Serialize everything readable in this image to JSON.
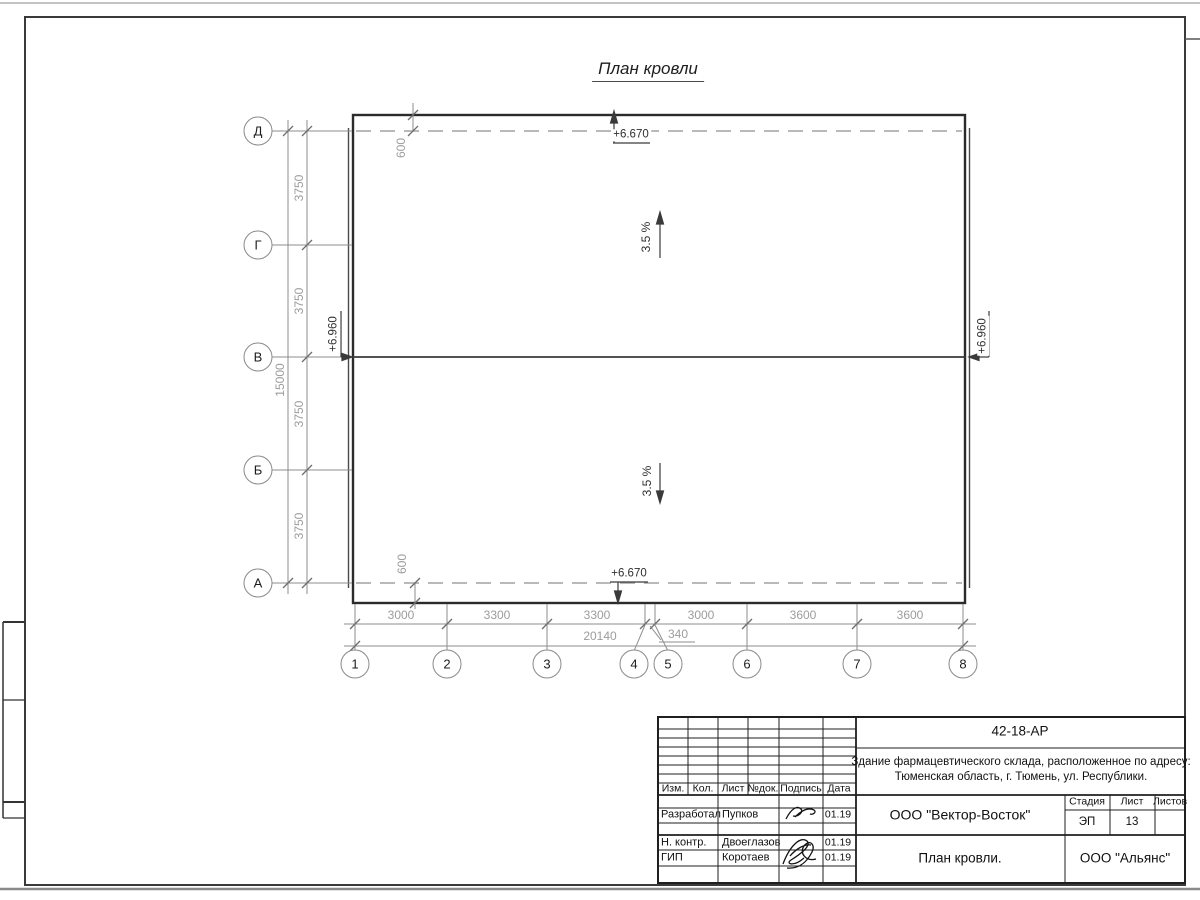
{
  "page": {
    "title": "План кровли"
  },
  "axes": {
    "rows": [
      "Д",
      "Г",
      "В",
      "Б",
      "А"
    ],
    "cols": [
      "1",
      "2",
      "3",
      "4",
      "5",
      "6",
      "7",
      "8"
    ]
  },
  "dims": {
    "row_segments": [
      "3750",
      "3750",
      "3750",
      "3750"
    ],
    "row_total": "15000",
    "col_segments": [
      "3000",
      "3300",
      "3300",
      "3000",
      "3600",
      "3600"
    ],
    "col_gap": "340",
    "col_total": "20140",
    "overhang_top": "600",
    "overhang_bottom": "600"
  },
  "marks": {
    "elev_top": "+6.670",
    "elev_bottom": "+6.670",
    "elev_left": "+6.960",
    "elev_right": "+6.960",
    "slope_top": "3.5 %",
    "slope_bottom": "3.5 %"
  },
  "titleblock": {
    "doc_code": "42-18-АР",
    "address_line1": "Здание фармацевтического склада, расположенное по адресу:",
    "address_line2": "Тюменская область, г. Тюмень, ул. Республики.",
    "org": "ООО \"Вектор-Восток\"",
    "sheet_title": "План кровли.",
    "contractor": "ООО \"Альянс\"",
    "cols": {
      "izm": "Изм.",
      "kol": "Кол.",
      "list": "Лист",
      "ndok": "№док.",
      "podpis": "Подпись",
      "data": "Дата"
    },
    "stage_cols": {
      "stage": "Стадия",
      "sheet": "Лист",
      "sheets": "Листов"
    },
    "stage": "ЭП",
    "sheet_no": "13",
    "rows": [
      {
        "role": "Разработал",
        "name": "Пупков",
        "date": "01.19"
      },
      {
        "role": "Н. контр.",
        "name": "Двоеглазов",
        "date": "01.19"
      },
      {
        "role": "ГИП",
        "name": "Коротаев",
        "date": "01.19"
      }
    ]
  }
}
